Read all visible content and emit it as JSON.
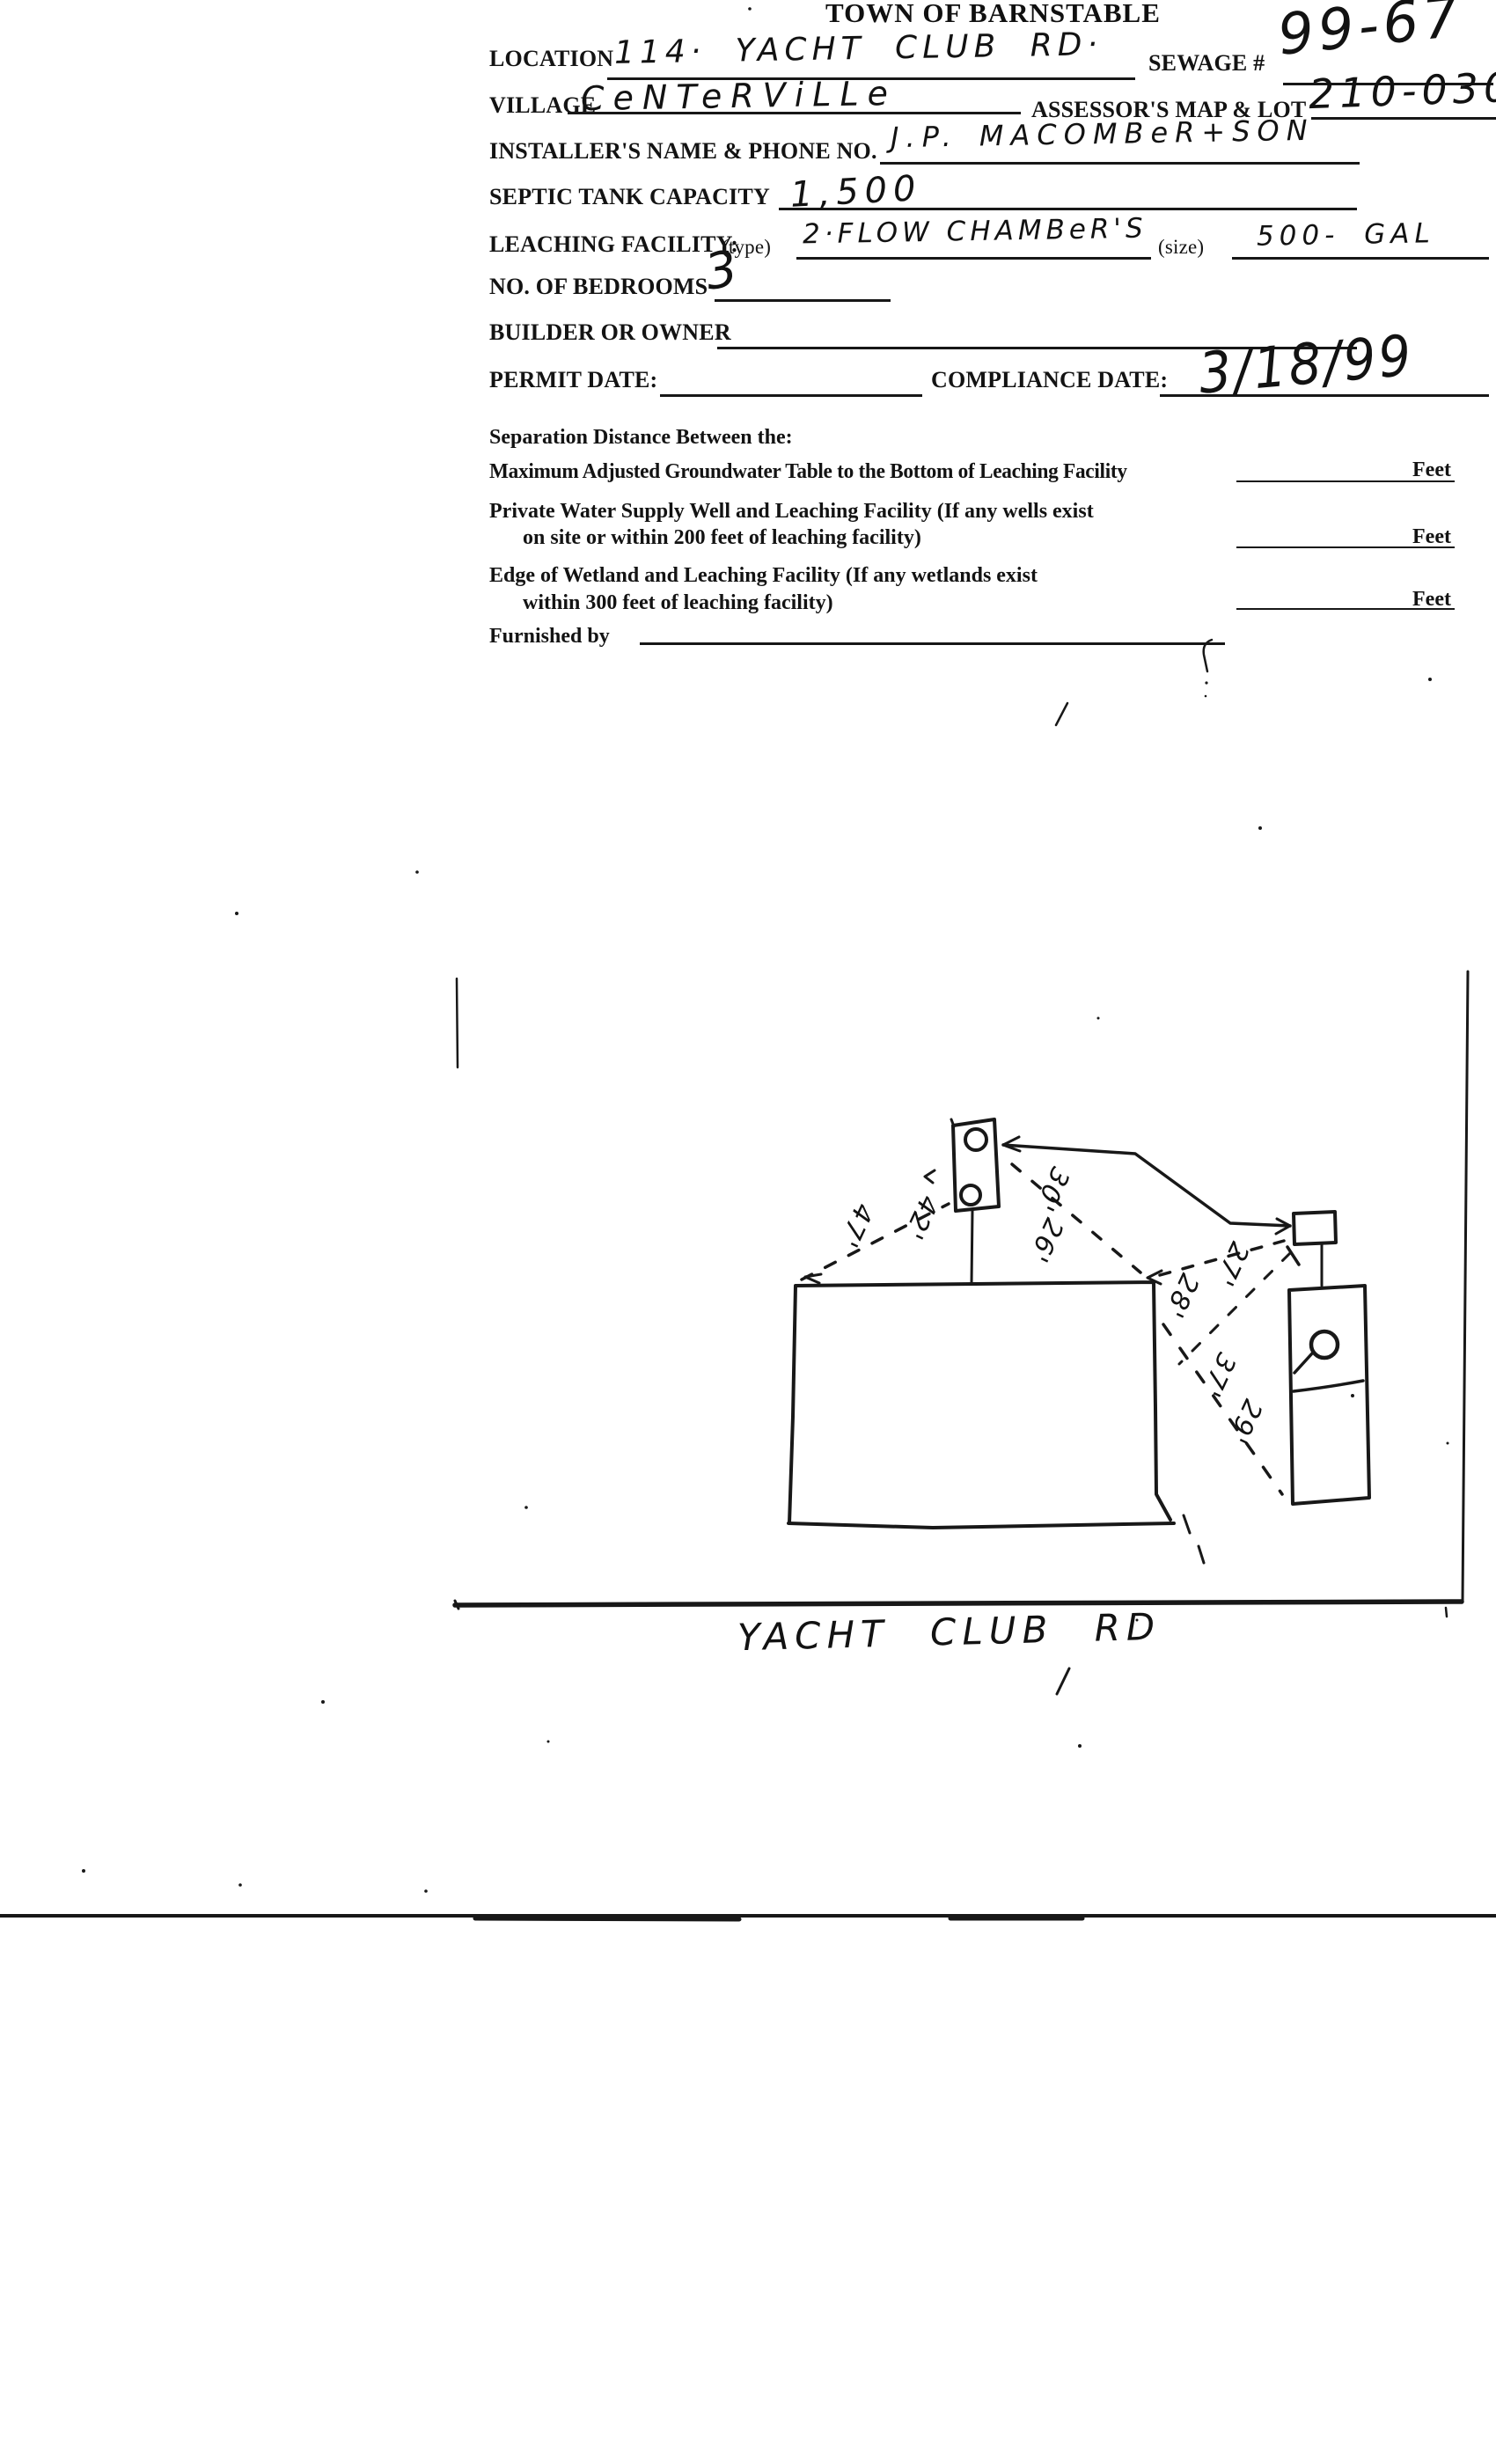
{
  "document": {
    "title": "TOWN OF BARNSTABLE",
    "form": {
      "location": {
        "label": "LOCATION",
        "value": "114· YACHT CLUB RD·"
      },
      "sewage": {
        "label": "SEWAGE #",
        "value": "99-67"
      },
      "village": {
        "label": "VILLAGE",
        "value": "CeNTeRViLLe"
      },
      "assessors": {
        "label": "ASSESSOR'S MAP & LOT",
        "value": "210-030"
      },
      "installer": {
        "label": "INSTALLER'S NAME & PHONE NO.",
        "value": "J.P. MACOMBeR+SON"
      },
      "septic_capacity": {
        "label": "SEPTIC TANK CAPACITY",
        "value": "1,500"
      },
      "leaching": {
        "label": "LEACHING FACILITY:",
        "type_label": "(type)",
        "type_value": "2·FLOW CHAMBeR'S",
        "size_label": "(size)",
        "size_value": "500- GAL"
      },
      "bedrooms": {
        "label": "NO. OF BEDROOMS",
        "value": "3"
      },
      "builder_owner": {
        "label": "BUILDER OR OWNER",
        "value": ""
      },
      "permit_date": {
        "label": "PERMIT DATE:",
        "value": ""
      },
      "compliance_date": {
        "label": "COMPLIANCE DATE:",
        "value": "3/18/99"
      }
    },
    "separation": {
      "heading": "Separation Distance Between the:",
      "rows": [
        {
          "line1": "Maximum Adjusted Groundwater Table to the Bottom of Leaching Facility",
          "line2": "",
          "unit": "Feet"
        },
        {
          "line1": "Private Water Supply Well and Leaching Facility  (If any wells exist",
          "line2": "on site or within 200 feet of leaching facility)",
          "unit": "Feet"
        },
        {
          "line1": "Edge of Wetland and Leaching Facility (If any wetlands exist",
          "line2": "within 300 feet of leaching facility)",
          "unit": "Feet"
        }
      ],
      "furnished_by_label": "Furnished by"
    },
    "sketch": {
      "road_label": "YACHT CLUB RD",
      "distance_labels": [
        {
          "text": "47'"
        },
        {
          "text": "42'"
        },
        {
          "text": "30'"
        },
        {
          "text": "26'"
        },
        {
          "text": "27'"
        },
        {
          "text": "28'"
        },
        {
          "text": "37'"
        },
        {
          "text": "29'"
        }
      ]
    }
  }
}
